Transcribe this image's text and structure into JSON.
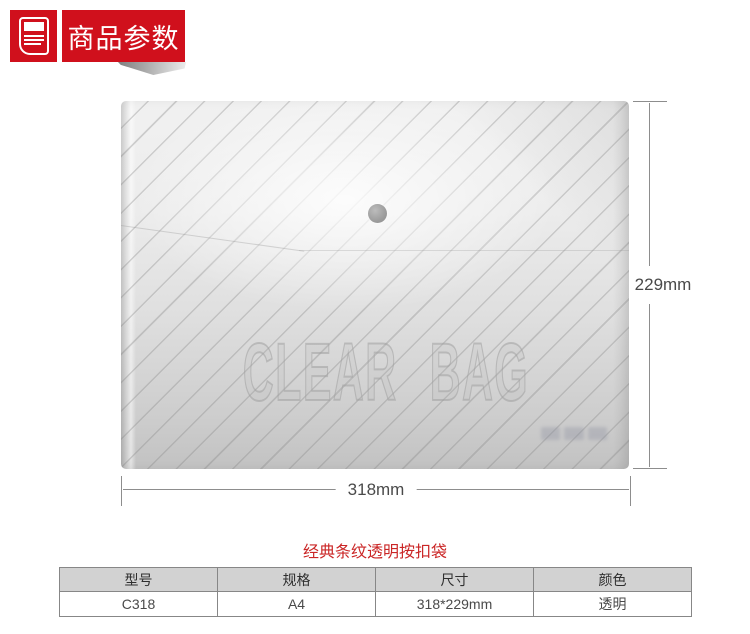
{
  "page": {
    "background": "#ffffff",
    "accent_red": "#d0101c"
  },
  "header": {
    "section_title": "商品参数",
    "icon": "document-icon"
  },
  "figure": {
    "bag_print_text": "CLEAR BAG",
    "width_label": "318mm",
    "height_label": "229mm",
    "dimension_line_color": "#8d8d8d",
    "dimension_text_color": "#4a4a4a",
    "bag_base_color": "#e0e0e0",
    "snap_button_color": "#9c9c9c"
  },
  "product": {
    "title": "经典条纹透明按扣袋",
    "title_color": "#ca2525"
  },
  "spec_table": {
    "header_bg": "#d2d2d2",
    "border_color": "#878787",
    "headers": [
      "型号",
      "规格",
      "尺寸",
      "颜色"
    ],
    "rows": [
      [
        "C318",
        "A4",
        "318*229mm",
        "透明"
      ]
    ]
  }
}
